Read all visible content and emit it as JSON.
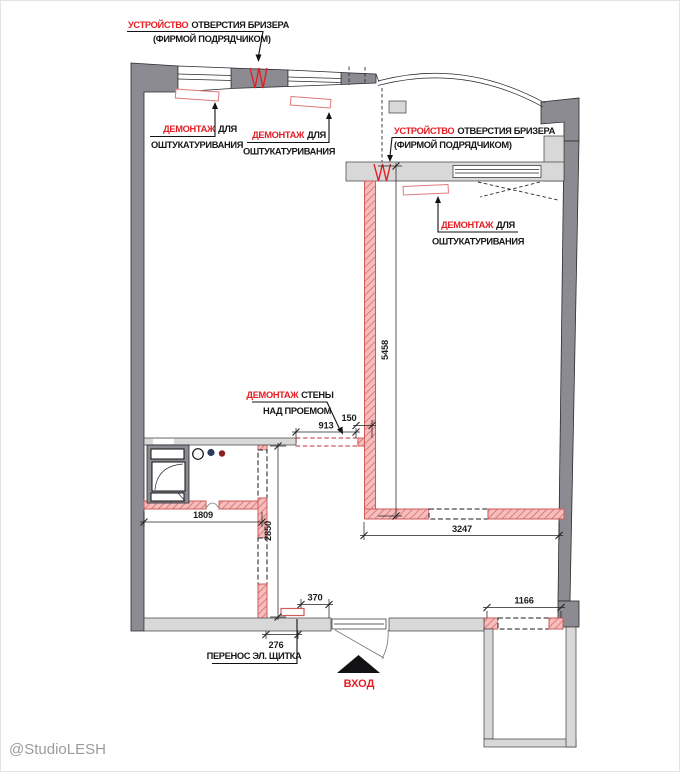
{
  "watermark": "@StudioLESH",
  "colors": {
    "annot-red": "#e31e24",
    "wall-dark": "#8b8b91",
    "wall-light": "#d8d8d8",
    "demo-fill": "#f6bdbd",
    "demo-stroke": "#cf5b5b",
    "wm-gray": "#9b9b9b"
  },
  "labels": {
    "breather_top": {
      "highlight": "УСТРОЙСТВО",
      "rest": "ОТВЕРСТИЯ БРИЗЕРА",
      "line2": "(ФИРМОЙ ПОДРЯДЧИКОМ)"
    },
    "breather_right": {
      "highlight": "УСТРОЙСТВО",
      "rest": "ОТВЕРСТИЯ БРИЗЕРА",
      "line2": "(ФИРМОЙ ПОДРЯДЧИКОМ)"
    },
    "demo_plaster": [
      {
        "highlight": "ДЕМОНТАЖ",
        "rest": "ДЛЯ",
        "line2": "ОШТУКАТУРИВАНИЯ"
      },
      {
        "highlight": "ДЕМОНТАЖ",
        "rest": "ДЛЯ",
        "line2": "ОШТУКАТУРИВАНИЯ"
      },
      {
        "highlight": "ДЕМОНТАЖ",
        "rest": "ДЛЯ",
        "line2": "ОШТУКАТУРИВАНИЯ"
      }
    ],
    "demo_wall": {
      "highlight": "ДЕМОНТАЖ",
      "rest": "СТЕНЫ",
      "line2": "НАД ПРОЕМОМ"
    },
    "panel_relocation": "ПЕРЕНОС ЭЛ. ЩИТКА",
    "entrance": "ВХОД"
  },
  "dimensions": {
    "opening_width": "913",
    "wall_remainder": "150",
    "partition_length": "5458",
    "kitchen_wall": "1809",
    "corridor_wall": "2850",
    "room_wall": "3247",
    "door_offset": "370",
    "panel_offset": "276",
    "balcony_opening": "1166"
  }
}
